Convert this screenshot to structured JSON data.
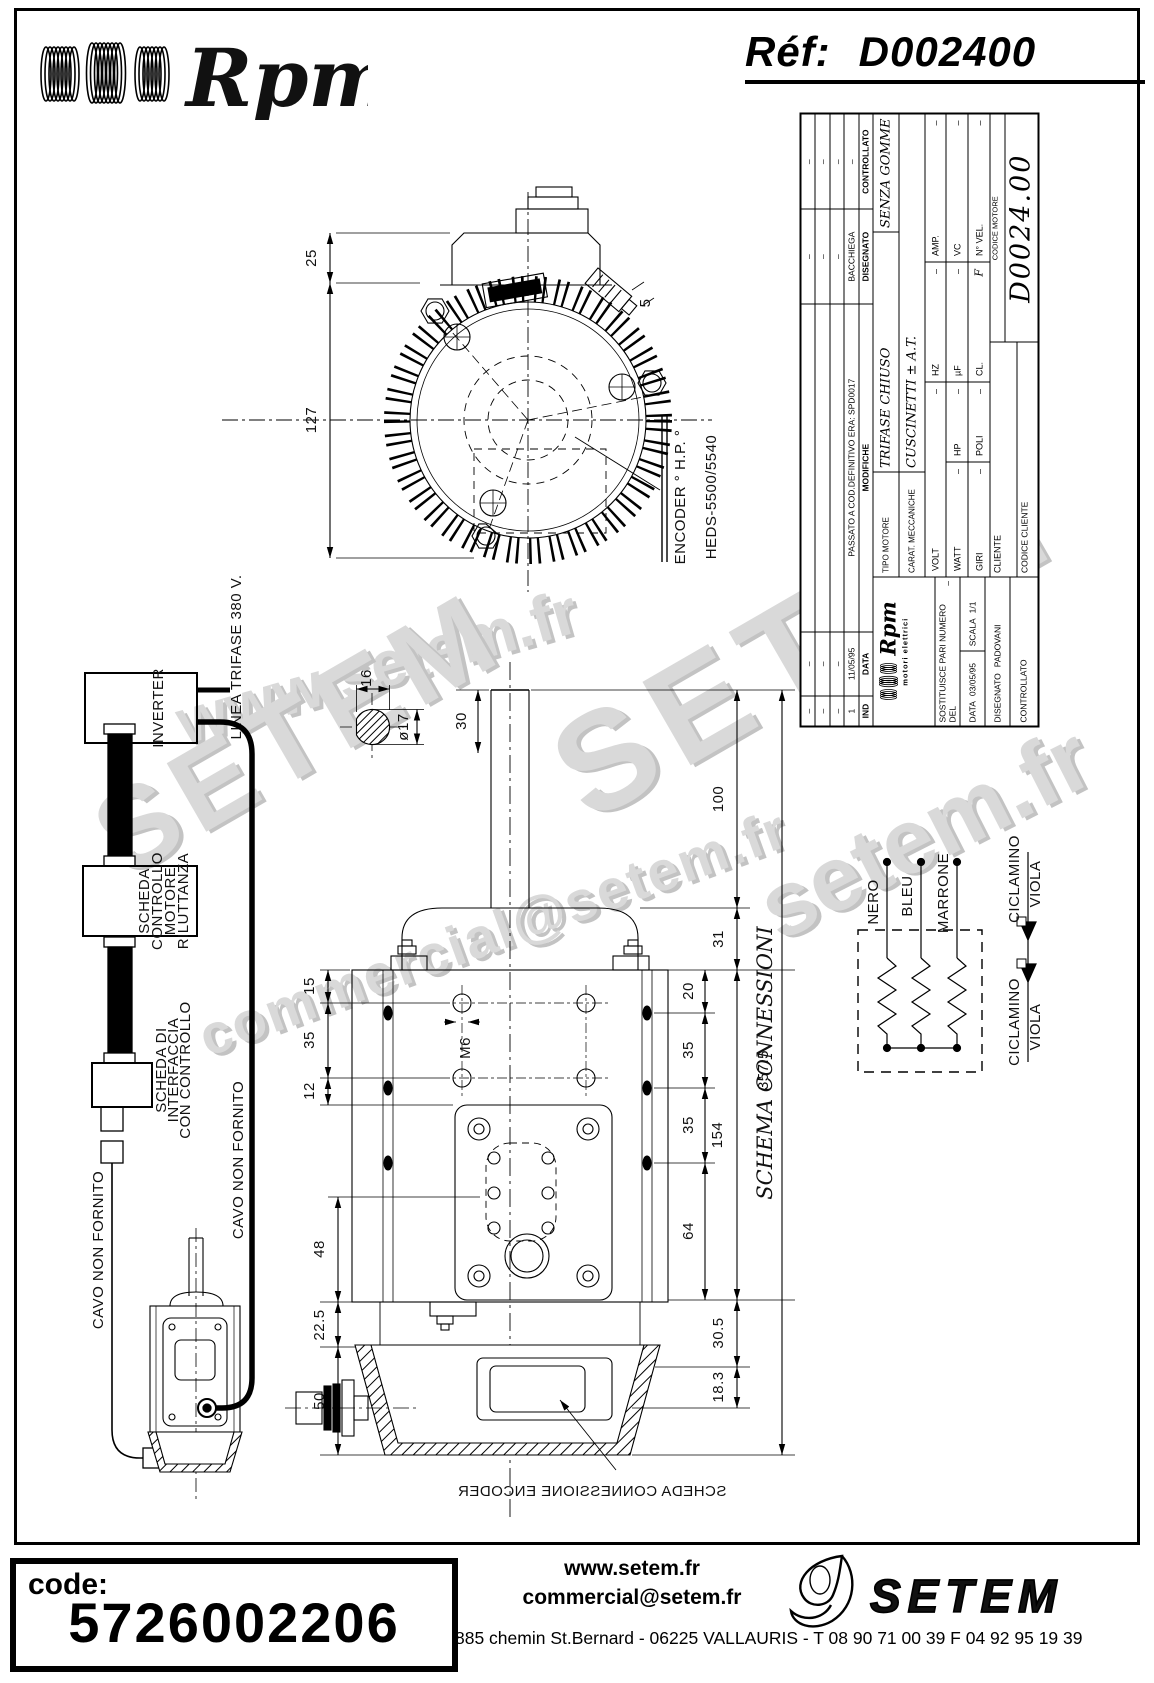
{
  "header": {
    "brand": "Rpm",
    "ref_label": "Réf:",
    "ref_value": "D002400"
  },
  "title_block": {
    "revisions": {
      "col_ind": "IND",
      "col_data": "DATA",
      "col_modifiche": "MODIFICHE",
      "col_disegnato": "DISEGNATO",
      "col_controllato": "CONTROLLATO",
      "rows": [
        {
          "ind": "–",
          "data": "–",
          "modifiche": "",
          "disegnato": "–",
          "controllato": "–"
        },
        {
          "ind": "–",
          "data": "–",
          "modifiche": "",
          "disegnato": "–",
          "controllato": "–"
        },
        {
          "ind": "–",
          "data": "–",
          "modifiche": "",
          "disegnato": "–",
          "controllato": "–"
        },
        {
          "ind": "1",
          "data": "11/05/95",
          "modifiche": "PASSATO A COD.DEFINITIVO ERA: SPD0017",
          "disegnato": "BACCHIEGA",
          "controllato": "–"
        }
      ]
    },
    "tipo_motore_label": "TIPO MOTORE",
    "tipo_motore_value": "TRIFASE CHIUSO",
    "carat_label": "CARAT. MECCANICHE",
    "carat_value": "CUSCINETTI ± A.T.",
    "carat_value_2": "SENZA GOMME",
    "volt_label": "VOLT",
    "volt_value": "–",
    "hz_label": "HZ",
    "hz_value": "–",
    "amp_label": "AMP.",
    "amp_value": "–",
    "watt_label": "WATT",
    "watt_value": "–",
    "hp_label": "HP",
    "hp_value": "–",
    "uf_label": "µF",
    "uf_value": "–",
    "vc_label": "VC",
    "vc_value": "–",
    "giri_label": "GIRI",
    "giri_value": "–",
    "poli_label": "POLI",
    "poli_value": "–",
    "cl_label": "CL.",
    "cl_value": "F",
    "nvel_label": "N° VEL.",
    "nvel_value": "–",
    "cliente_label": "CLIENTE",
    "codice_cliente_label": "CODICE CLIENTE",
    "codice_motore_label": "CODICE MOTORE",
    "codice_motore_value": "D0024.00",
    "logo_brand": "Rpm",
    "logo_sub": "motori elettrici",
    "sostituisce_label": "SOSTITUISCE PARI NUMERO DEL",
    "sostituisce_value": "–",
    "data_label": "DATA",
    "data_value": "03/05/95",
    "scala_label": "SCALA",
    "scala_value": "1/1",
    "disegnato_label": "DISEGNATO",
    "disegnato_value": "PADOVANI",
    "controllato_label": "CONTROLLATO"
  },
  "block_diagram": {
    "linea_label": "LINEA TRIFASE 380 V.",
    "inverter_label": "INVERTER",
    "scheda_controllo_lines": [
      "SCHEDA",
      "CONTROLLO",
      "MOTORE",
      "RILUTTANZA"
    ],
    "scheda_interfaccia_lines": [
      "SCHEDA DI",
      "INTERFACCIA",
      "CON CONTROLLO"
    ],
    "cavo_left": "CAVO NON FORNITO",
    "cavo_right": "CAVO NON FORNITO"
  },
  "front_view": {
    "dim_25": "25",
    "dim_127": "127",
    "dim_5": "5",
    "encoder_label": "ENCODER ° H.P. °",
    "encoder_model": "HEDS-5500/5540"
  },
  "shaft_detail": {
    "dim_16": "16",
    "dim_dia": "ø17",
    "dim_30": "30"
  },
  "side_view": {
    "dim_15": "15",
    "dim_35a": "35",
    "dim_12": "12",
    "dim_48": "48",
    "dim_22_5": "22.5",
    "dim_50": "50",
    "dim_20": "20",
    "dim_35b": "35",
    "dim_35c": "35",
    "dim_64": "64",
    "dim_154": "154",
    "dim_100": "100",
    "dim_31": "31",
    "dim_30_5": "30.5",
    "dim_18_3": "18.3",
    "dim_357_5": "357.5",
    "m6_label": "M6",
    "encoder_board_label": "SCHEDA CONNESSIONE ENCODER"
  },
  "schema": {
    "title": "SCHEMA CONNESSIONI",
    "wire_1": "NERO",
    "wire_2": "BLEU",
    "wire_3": "MARRONE",
    "pair_top_1": "CICLAMINO",
    "pair_top_2": "VIOLA",
    "pair_bottom_1": "CICLAMINO",
    "pair_bottom_2": "VIOLA"
  },
  "watermarks": {
    "w1": "www.setem.fr",
    "w2": "SETEM",
    "w3": "SETEM",
    "w4": "commercial@setem.fr",
    "w5": "setem.fr"
  },
  "footer": {
    "code_label": "code:",
    "code_value": "5726002206",
    "website": "www.setem.fr",
    "email": "commercial@setem.fr",
    "address": "885 chemin St.Bernard  -  06225 VALLAURIS  -  T 08 90 71 00 39   F 04 92 95 19 39",
    "brand": "SETEM"
  }
}
